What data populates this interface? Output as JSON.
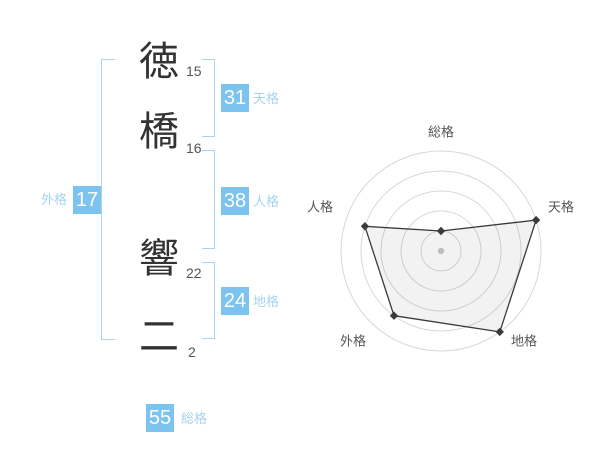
{
  "colors": {
    "badge_blue": "#7cc3ef",
    "light_blue": "#a5d4f2",
    "bracket_blue": "#a9d5f3",
    "text_dark": "#333333",
    "stroke_count_gray": "#555555",
    "radar_ring_gray": "#d8d8d8",
    "radar_line_dark": "#3a3a3a",
    "radar_fill": "rgba(0,0,0,0.05)",
    "center_dot_gray": "#bdbdbd"
  },
  "name": {
    "characters": [
      {
        "char": "徳",
        "strokes": "15"
      },
      {
        "char": "橋",
        "strokes": "16"
      },
      {
        "char": "響",
        "strokes": "22"
      },
      {
        "char": "二",
        "strokes": "2"
      }
    ]
  },
  "categories": {
    "tenkaku": {
      "value": "31",
      "label": "天格"
    },
    "jinkaku": {
      "value": "38",
      "label": "人格"
    },
    "chikaku": {
      "value": "24",
      "label": "地格"
    },
    "gaikaku": {
      "value": "17",
      "label": "外格"
    },
    "soukaku": {
      "value": "55",
      "label": "総格"
    }
  },
  "chart_data": {
    "type": "radar",
    "axes": [
      "総格",
      "天格",
      "地格",
      "外格",
      "人格"
    ],
    "values": [
      1,
      5,
      5,
      4,
      4
    ],
    "scale_max": 5,
    "rings": 5,
    "grid": "concentric-circles",
    "legend": "none",
    "center_marker": true
  }
}
